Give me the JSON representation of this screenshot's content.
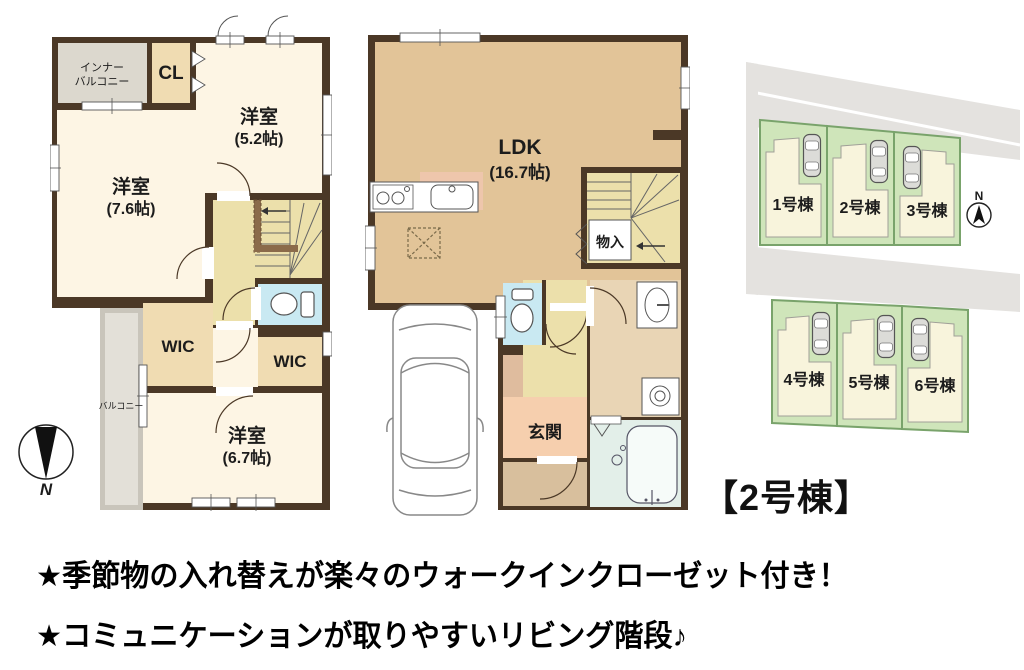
{
  "captions": {
    "unit": "【2号棟】",
    "features": [
      "★季節物の入れ替えが楽々のウォークインクローゼット付き！",
      "★コミュニケーションが取りやすいリビング階段♪"
    ]
  },
  "plan_2f": {
    "inner_balcony_line1": "インナー",
    "inner_balcony_line2": "バルコニー",
    "closet": "CL",
    "room_5_2_name": "洋室",
    "room_5_2_size": "(5.2帖)",
    "room_7_6_name": "洋室",
    "room_7_6_size": "(7.6帖)",
    "wic_left": "WIC",
    "wic_right": "WIC",
    "room_6_7_name": "洋室",
    "room_6_7_size": "(6.7帖)",
    "balcony": "バルコニー",
    "compass_n": "N"
  },
  "plan_1f": {
    "ldk_name": "LDK",
    "ldk_size": "(16.7帖)",
    "storage": "物入",
    "entrance": "玄関"
  },
  "site_plan": {
    "lots": [
      {
        "label": "1号棟"
      },
      {
        "label": "2号棟"
      },
      {
        "label": "3号棟"
      },
      {
        "label": "4号棟"
      },
      {
        "label": "5号棟"
      },
      {
        "label": "6号棟"
      }
    ],
    "compass_n": "N"
  },
  "colors": {
    "wall": "#4b3826",
    "room_cream": "#fdf5e4",
    "ldk_tan": "#e2c498",
    "closet_beige": "#f0dcb2",
    "stair_khaki": "#ece0ab",
    "toilet_blue": "#c9e9f2",
    "balcony_gray": "#d8d4ca",
    "entrance_salmon": "#f6cfae",
    "bath_green": "#e3efe9",
    "lot_green": "#cfe5ba",
    "road_gray": "#e4e2df",
    "house_cream": "#f8f4dc"
  }
}
